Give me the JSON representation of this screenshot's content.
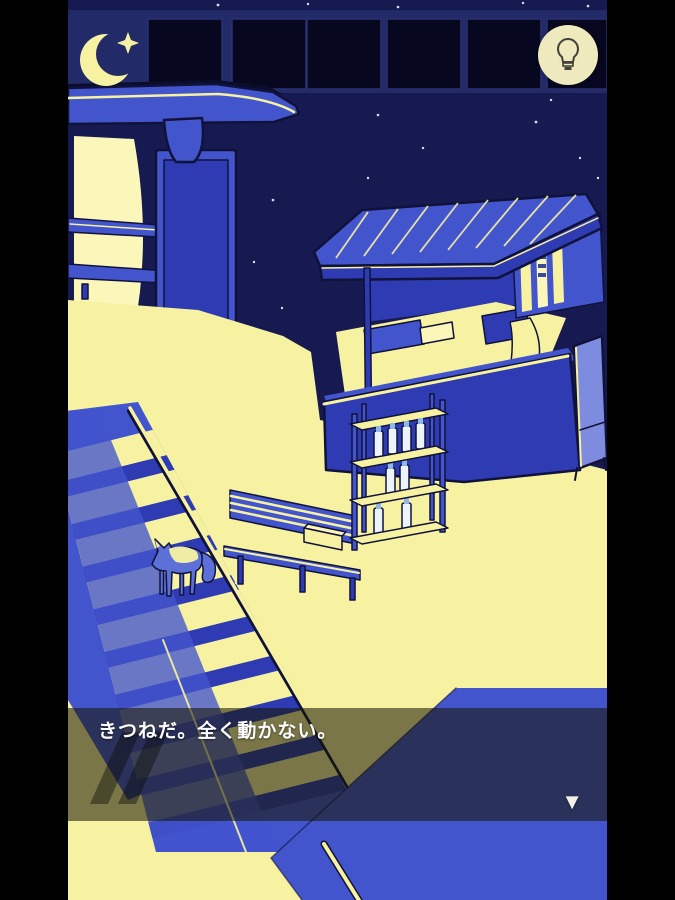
{
  "hud": {
    "moon_icon": "crescent-moon-with-sparkle",
    "hint_button": {
      "icon": "lightbulb",
      "shape": "circle"
    }
  },
  "dialogue": {
    "text": "きつねだ。全く動かない。",
    "skip_icon": "fast-rewind-double-slash",
    "advance_glyph": "▼"
  },
  "scene": {
    "setting": "night-station-platform",
    "objects": [
      "dark-windows",
      "stars",
      "bus-shelter-canopy",
      "illuminated-panel",
      "station-sign",
      "shelter-bench",
      "staircase",
      "stair-railing",
      "fox",
      "platform-bench",
      "bench-box",
      "kiosk",
      "kiosk-banners",
      "beverage-shelf",
      "bottles",
      "a-frame-sign"
    ]
  },
  "palette": {
    "sky": "#161a50",
    "band": "#232a68",
    "window": "#07081f",
    "blue-mid": "#4355cd",
    "blue-deep": "#2e3bb2",
    "outline": "#10123a",
    "cream": "#f7f2a2",
    "cream-bright": "#fbf7bb",
    "fox-blue": "#5c70d8",
    "bottle": "#edf3fa",
    "bottle-cap": "#8fb9e4",
    "hint-bg": "#eeeabd",
    "hint-glyph": "#44433a",
    "overlay": "rgba(24,22,2,0.56)",
    "text": "#ffffff",
    "black": "#000000"
  }
}
